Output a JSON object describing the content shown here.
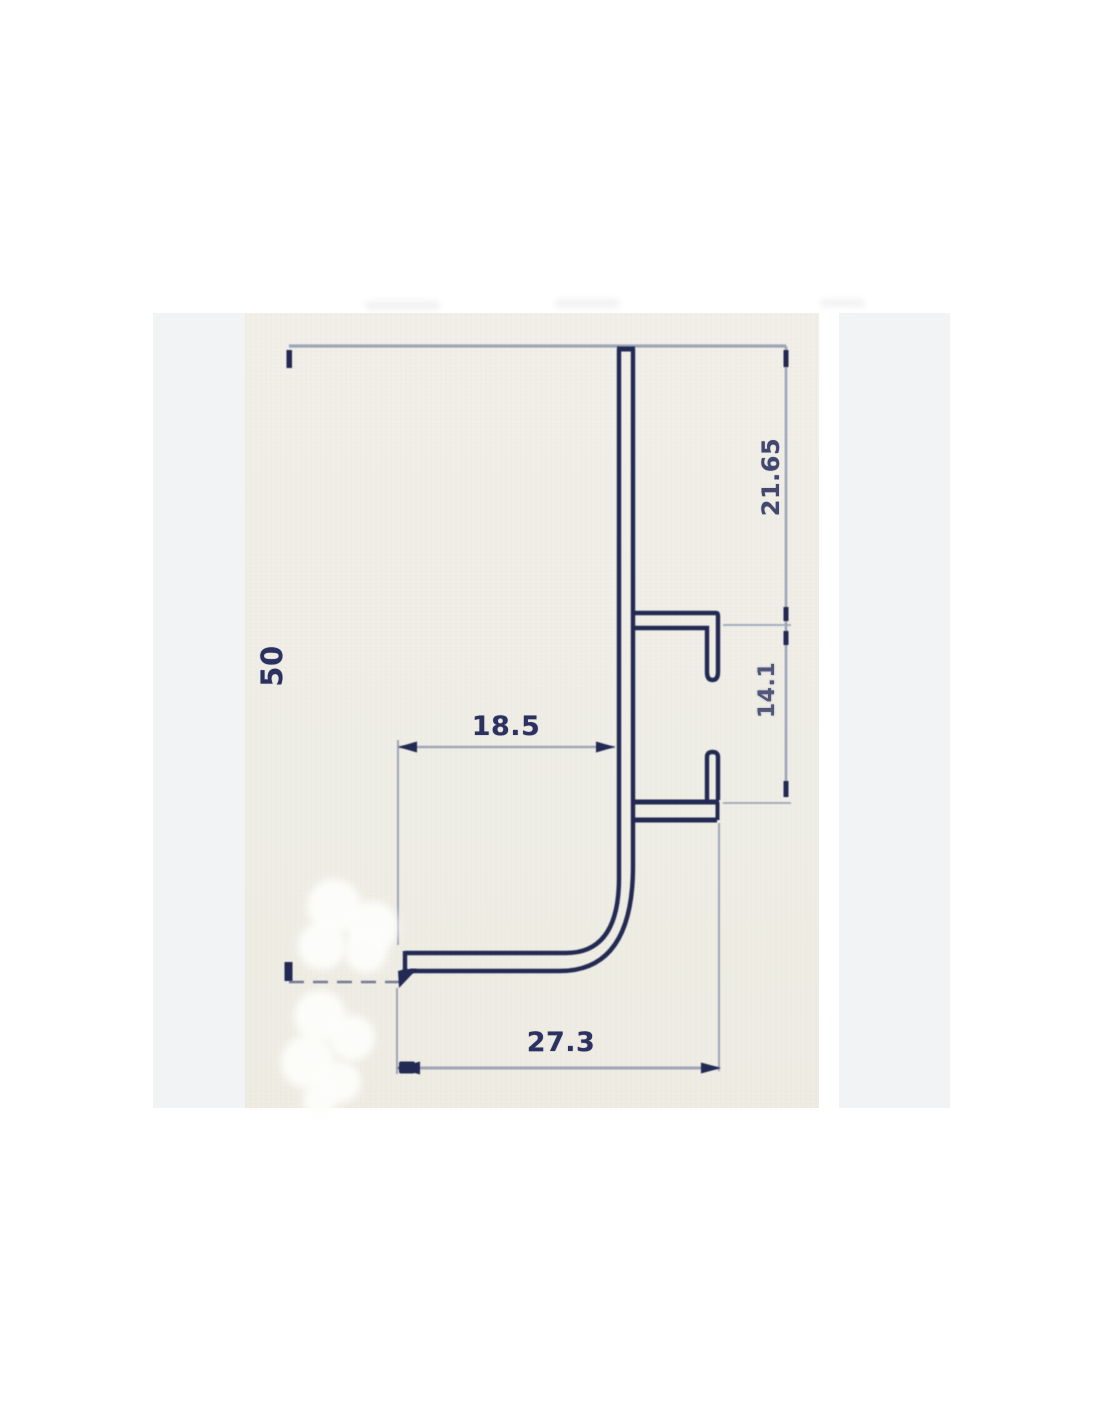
{
  "drawing": {
    "type": "technical cross-section drawing of an L-shaped aluminium profile with clip channels",
    "dimension_labels": {
      "height": "50",
      "top_segment": "21.65",
      "slot_segment": "14.1",
      "inner_width": "18.5",
      "outer_width": "27.3"
    }
  },
  "colors": {
    "page_background": "#ffffff",
    "panel_background": "#f2f3f5",
    "scan_background": "#f0eee6",
    "profile_line": "#232a52",
    "dimension_line": "#9aa1b6",
    "dimension_line_dark": "#454b66",
    "label_text": "#2b3160",
    "whiteout_blob": "#fdfdfb"
  }
}
